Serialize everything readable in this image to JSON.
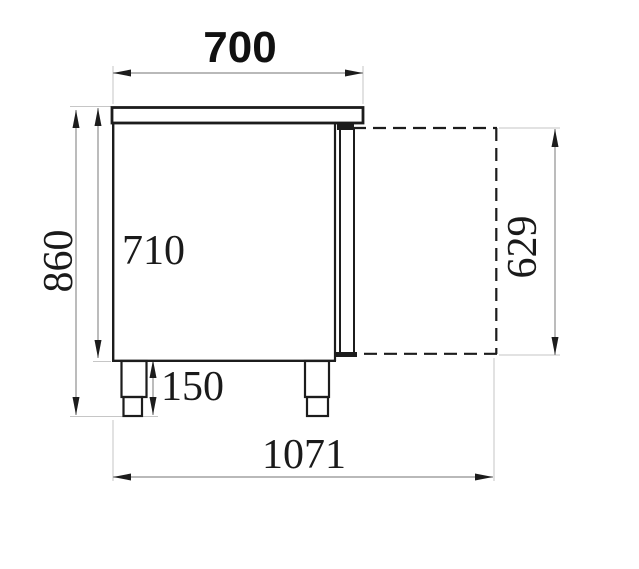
{
  "diagram": {
    "type": "technical-drawing",
    "view": "side-elevation",
    "subject": "refrigerated counter with open door envelope",
    "units": "mm",
    "background_color": "#ffffff",
    "outline_color": "#1c1c1c",
    "dimension_line_color": "#8f8f8f",
    "extension_line_color": "#c6c6c6",
    "text_color": "#1a1a1a"
  },
  "dims": {
    "width_top": "700",
    "height_total": "860",
    "height_body": "710",
    "height_door_open": "629",
    "leg_height": "150",
    "depth_door_open": "1071"
  }
}
